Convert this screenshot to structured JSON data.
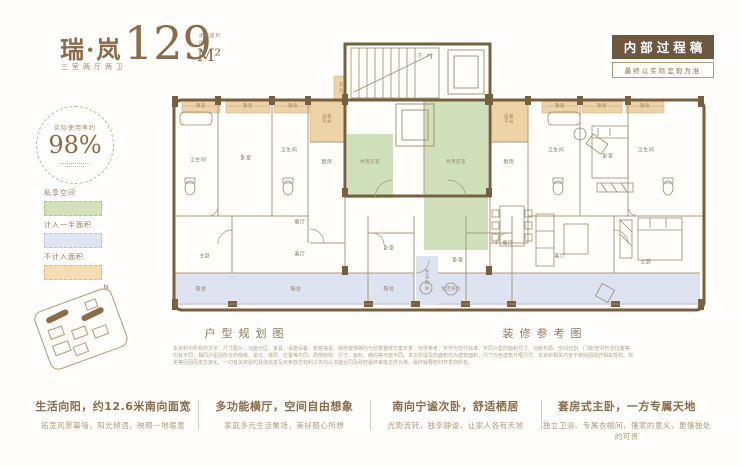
{
  "header": {
    "logo_title": "瑞·岚",
    "logo_subtitle": "三室两厅两卫",
    "area_number": "129",
    "area_unit": "M²",
    "area_note_1": "建筑面积",
    "area_note_2": "约",
    "badge_title": "内部过程稿",
    "badge_subtitle": "最终以实际呈现为准"
  },
  "left_panel": {
    "ratio_label": "实际使用率约",
    "ratio_value": "98%",
    "compass_label": "N",
    "legend": [
      {
        "label": "私享空间",
        "color": "#d3e2bd"
      },
      {
        "label": "计入一半面积",
        "color": "#e0e5f2"
      },
      {
        "label": "不计入面积",
        "color": "#f4dcb4"
      }
    ]
  },
  "plan": {
    "caption_left": "户型规划图",
    "caption_right": "装修参考图",
    "rooms": [
      "卫生间",
      "卧室",
      "卫生间",
      "厨房",
      "设备平台",
      "平台",
      "下",
      "共用前室",
      "共用前室",
      "餐厅",
      "客厅",
      "主卧",
      "卧室",
      "阳台",
      "阳台",
      "阳台",
      "生活阳台",
      "设备平台",
      "厨房",
      "卫生间",
      "卧室",
      "卫生间",
      "卧室",
      "餐厅",
      "客厅",
      "主卧",
      "生活阳台",
      "飘窗",
      "飘窗",
      "飘窗",
      "飘窗",
      "飘窗",
      "飘窗"
    ]
  },
  "disclaimer": {
    "lines": [
      "本资料中所有的文字、尺寸图片、功能分区、家具、设施设备、软装摆设、装修装饰等均为创意装修方案示意，仅供参考，不作为交付标准。不同户型的面积尺寸、功能布局、空间分割、门窗/管井形态位置等",
      "均有不同；相同户型因所在的楼栋、单元、楼层、位置等不同，局部结构、尺寸、面积、朝向等可能不同。本文所提及的面积均为建筑面积，尺寸均含建筑外框尺寸。本资料相关内容不排除因政府相关规划、规",
      "定等原因而发生变化。一切有关房屋的具体信息及买卖双方权利义务均以书面合同及政府最终审批文件为准。最终解释权归开发商所有。"
    ]
  },
  "features": [
    {
      "title": "生活向阳，约12.6米南向面宽",
      "desc": "拓宽风景幕墙，阳光倾洒，映照一地暖意"
    },
    {
      "title": "多功能横厅，空间自由想象",
      "desc": "家庭多元生活聚场，美好随心所想"
    },
    {
      "title": "南向宁谧次卧，舒适栖居",
      "desc": "光影流转，独享静谧，让家人各有天地"
    },
    {
      "title": "套房式主卧，一方专属天地",
      "desc": "独立卫浴、专属衣帽间，懂家的意义，更懂独处的可贵"
    }
  ],
  "colors": {
    "accent": "#8a6b4a",
    "badge_bg": "#6d5741",
    "wall": "#77603f",
    "private_green": "#d3e2bd",
    "half_area_blue": "#e0e5f2",
    "uncounted_tan": "#eed3a6"
  }
}
